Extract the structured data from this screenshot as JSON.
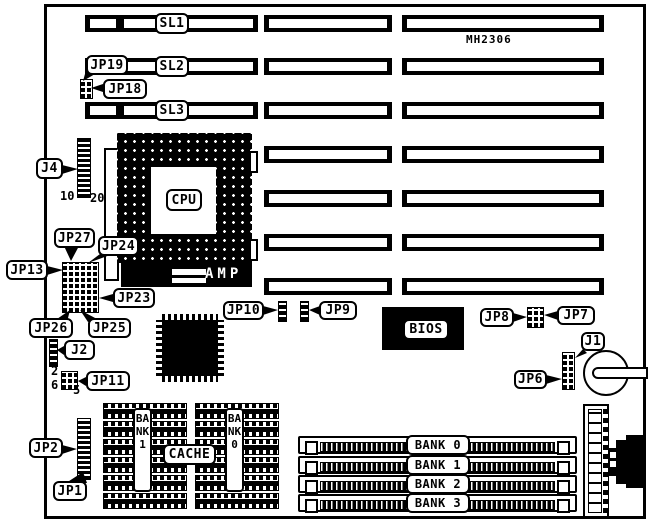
{
  "model": "MH2306",
  "slots": {
    "sl1": "SL1",
    "sl2": "SL2",
    "sl3": "SL3"
  },
  "chips": {
    "cpu": "CPU",
    "amp": "AMP",
    "bios": "BIOS",
    "cache": "CACHE"
  },
  "cache_banks": {
    "left": "BANK 1",
    "right": "BANK 0"
  },
  "memory_banks": [
    "BANK 0",
    "BANK 1",
    "BANK 2",
    "BANK 3"
  ],
  "jumpers": {
    "j4": "J4",
    "jp19": "JP19",
    "jp18": "JP18",
    "jp27": "JP27",
    "jp24": "JP24",
    "jp13": "JP13",
    "jp23": "JP23",
    "jp26": "JP26",
    "jp25": "JP25",
    "j2": "J2",
    "jp11": "JP11",
    "jp2": "JP2",
    "jp1": "JP1",
    "jp10": "JP10",
    "jp9": "JP9",
    "jp8": "JP8",
    "jp7": "JP7",
    "j1": "J1",
    "jp6": "JP6"
  },
  "pin_labels": {
    "j4_start": "10",
    "j4_end": "20",
    "jp11_top": "2",
    "jp11_bottom": "6",
    "jp11_corner": "5"
  }
}
